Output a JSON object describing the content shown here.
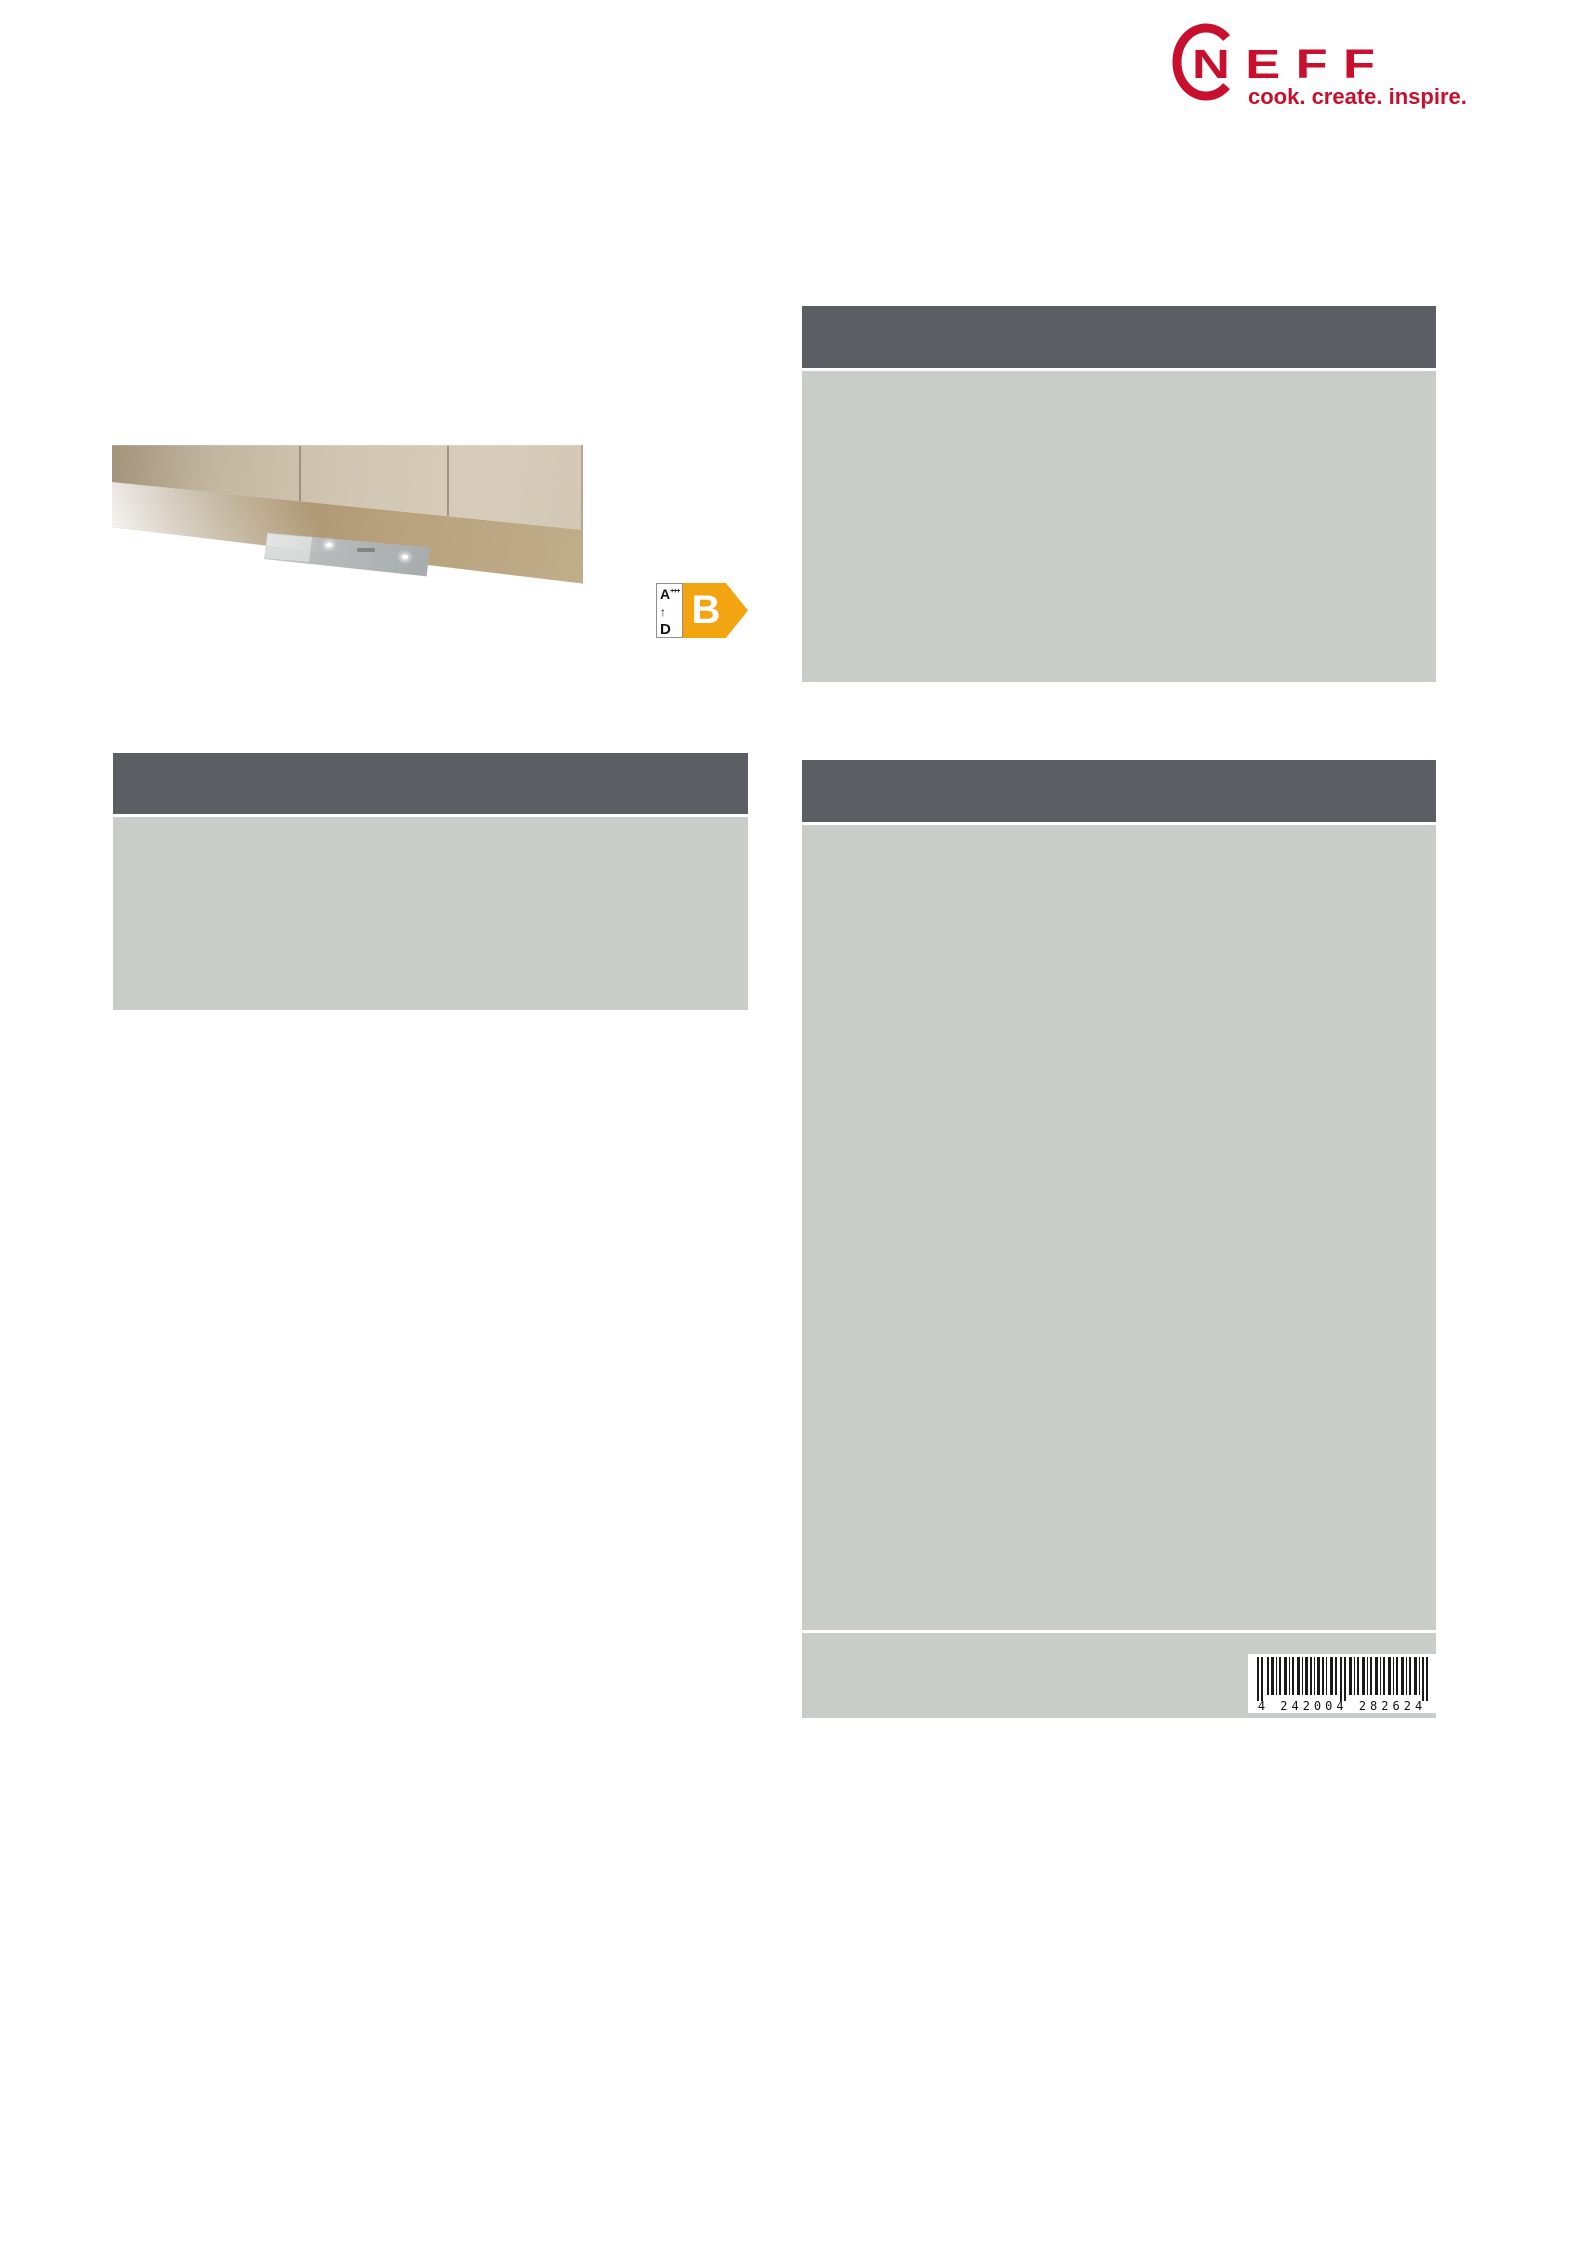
{
  "colors": {
    "brand": "#c8102e",
    "panel-header": "#5b5f64",
    "panel-body": "#c9cdca",
    "energy-arrow": "#f2a411",
    "barcode-ink": "#1a1a1a"
  },
  "brand": {
    "name": "NEFF",
    "tagline": "cook. create. inspire."
  },
  "product_image": {
    "alt": "Built-under canopy cooker hood installed beneath beige kitchen wall cabinets"
  },
  "energy_label": {
    "best_class": "A",
    "best_class_suffix": "+++",
    "range_arrow": "↑",
    "worst_class": "D",
    "rating": "B"
  },
  "barcode": {
    "digits": "4 242004 282624"
  }
}
